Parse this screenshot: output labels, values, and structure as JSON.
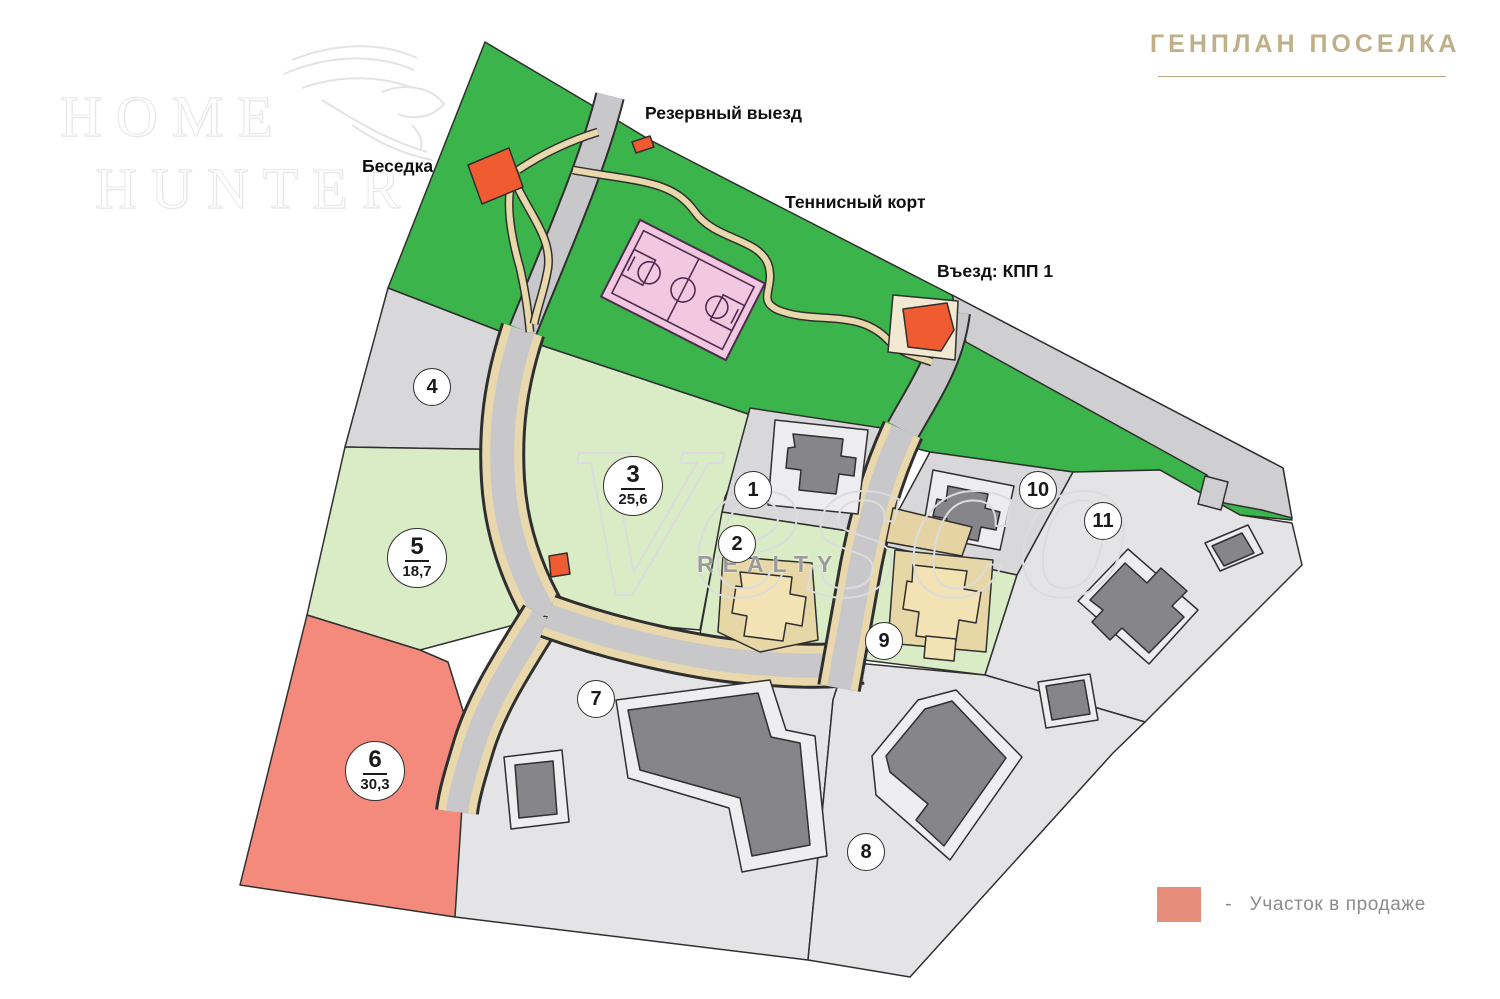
{
  "header": {
    "title": "ГЕНПЛАН ПОСЕЛКА"
  },
  "logo": {
    "word1": "HOME",
    "word2": "HUNTER"
  },
  "watermark": {
    "brand": "Vesco",
    "sub": "REALTY"
  },
  "map_labels": {
    "gazebo": "Беседка",
    "reserve_exit": "Резервный выезд",
    "tennis_court": "Теннисный корт",
    "entrance_checkpoint": "Въезд: КПП 1"
  },
  "plots": [
    {
      "number": "1",
      "area": ""
    },
    {
      "number": "2",
      "area": ""
    },
    {
      "number": "3",
      "area": "25,6"
    },
    {
      "number": "4",
      "area": ""
    },
    {
      "number": "5",
      "area": "18,7"
    },
    {
      "number": "6",
      "area": "30,3"
    },
    {
      "number": "7",
      "area": ""
    },
    {
      "number": "8",
      "area": ""
    },
    {
      "number": "9",
      "area": ""
    },
    {
      "number": "10",
      "area": ""
    },
    {
      "number": "11",
      "area": ""
    }
  ],
  "legend": {
    "dash": "-",
    "label": "Участок в продаже",
    "swatch_color": "#e78d7b"
  },
  "colors": {
    "forest_green": "#3ab44b",
    "plot_green": "#d9ecc6",
    "plot_gray": "#d8d8da",
    "plot_light_gray": "#e4e4e6",
    "plot_for_sale": "#f48a7c",
    "road_gray": "#c8c8ca",
    "road_band_gray": "#cfcfd1",
    "path_tan": "#e9d8ab",
    "structure_orange": "#f15b31",
    "court_pink": "#f2c8e0",
    "court_line_purple": "#4f2b50",
    "house_gray": "#86868a",
    "house_pad_gray": "#ededef",
    "house_beige": "#f2e2b4",
    "kpp_pad": "#f1e9d2",
    "outline_dark": "#2f2f2f"
  }
}
